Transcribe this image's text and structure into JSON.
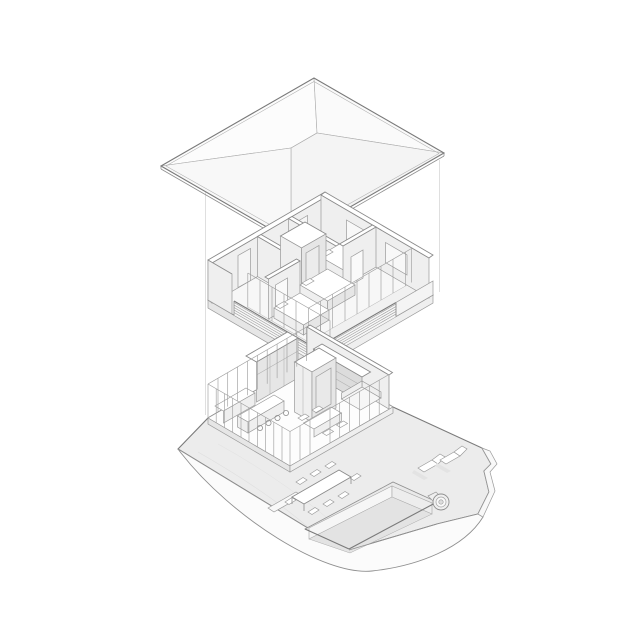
{
  "figure": {
    "title": "Exploded axonometric drawing of a two-storey villa with hip roof, upper bedroom floor and ground floor pavilion with terrace and pool",
    "type": "exploded-axonometric",
    "background": "#ffffff",
    "palette": {
      "line": "#8a8a8a",
      "line_dark": "#7a7a7a",
      "line_light": "#b0b0b0",
      "surface_white": "#ffffff",
      "surface_light": "#f7f7f7",
      "terrace_gray": "#ececec",
      "wall_gray": "#efefef",
      "shelf_gray": "#dcdcdc",
      "guide_gray": "#dcdcdc"
    },
    "levels": [
      {
        "id": "roof",
        "label": "Hip roof"
      },
      {
        "id": "upper-floor",
        "label": "Upper floor with bedrooms, stair core and louvred balcony"
      },
      {
        "id": "ground-floor",
        "label": "Ground floor pavilion with kitchen, living room, terrace and pool"
      }
    ],
    "features": [
      {
        "id": "guide-lines",
        "label": "Vertical alignment guides between exploded levels"
      },
      {
        "id": "stair-core",
        "label": "Central stair core"
      },
      {
        "id": "balcony-railing",
        "label": "Louvred balcony railing"
      },
      {
        "id": "kitchen-island",
        "label": "Kitchen island with bar stools"
      },
      {
        "id": "outdoor-dining-table",
        "label": "Outdoor dining table with eight chairs"
      },
      {
        "id": "pool",
        "label": "Sunken swimming pool shown in section"
      },
      {
        "id": "sun-loungers",
        "label": "Two sun loungers"
      },
      {
        "id": "pool-pump",
        "label": "Round plunge tub at pool corner"
      },
      {
        "id": "terrace",
        "label": "Stone terrace with cut terrain edge"
      }
    ]
  }
}
